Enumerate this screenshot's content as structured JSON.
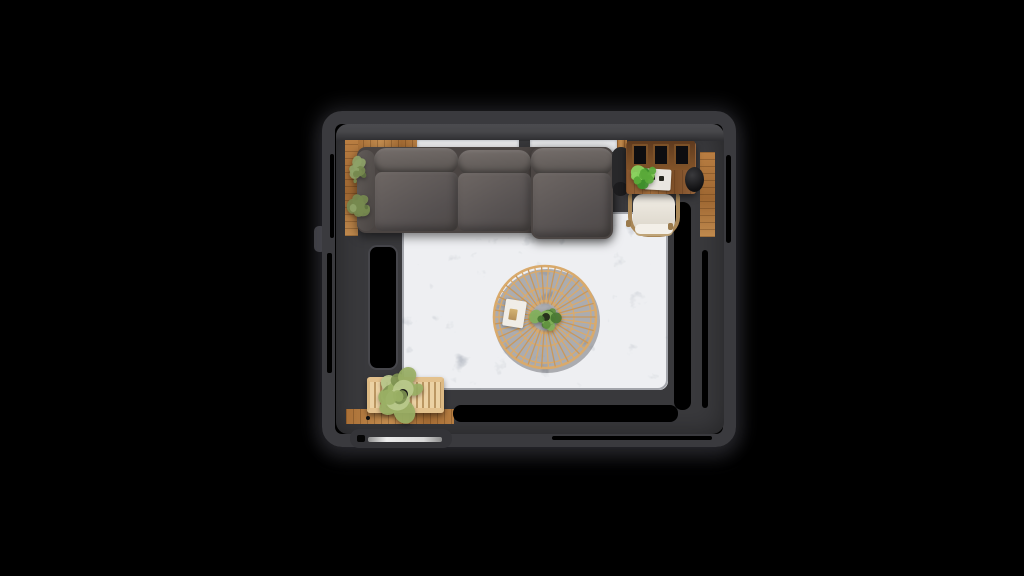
{
  "meta": {
    "description": "Top-down 3D interior render of a living room on a black background",
    "image_type": "3d-room-render-top-view",
    "visible_text": "none"
  },
  "theme": {
    "bg": "#000000",
    "wall": "#3a3a3e",
    "wall_surface": "#39393c",
    "wall_highlight": "#4b4b4f",
    "wall_shadow": "#2d2d30",
    "window": "#e9eaec",
    "wood_floor": "#b0763b",
    "wood_floor_light": "#c28c4f",
    "desk_wood": "#8a5830",
    "bench_wood": "#ecd2a4",
    "rug_base": "#b9bdc4",
    "rug_dark_mottle": "#8f959e",
    "rug_light_mottle": "#e2e4e7",
    "leather": "#5c5654",
    "leather_light": "#6e6764",
    "leather_dark": "#4a4442",
    "rattan": "#d9aa6c",
    "chair_wood": "#a98757",
    "chair_cream": "#eae5dd",
    "magazine": "#f0ede7",
    "door_white": "#e0e0e0"
  },
  "room": {
    "windows_on_top_wall": 2,
    "left_wall_opening": "black window/door cutout",
    "bottom_left": "white door slab in wall",
    "floor": [
      "wood border strips",
      "gray marble-pattern area rug"
    ]
  },
  "furniture": [
    {
      "name": "sectional-sofa",
      "seats": 3,
      "chaise_side": "right",
      "color": "#5c5654"
    },
    {
      "name": "rattan-coffee-table",
      "shape": "round",
      "color": "#d9aa6c"
    },
    {
      "name": "magazine",
      "color": "#f0ede7"
    },
    {
      "name": "desk",
      "frames_on_shelf": 3,
      "color": "#8a5830"
    },
    {
      "name": "desk-chair",
      "cushion": "#eae5dd",
      "frame": "#a98757"
    },
    {
      "name": "speaker",
      "color": "#1b1b1d"
    },
    {
      "name": "side-lamp",
      "color": "#28282a"
    },
    {
      "name": "bench",
      "style": "slatted",
      "color": "#ecd2a4"
    },
    {
      "name": "door",
      "color": "#e0e0e0"
    }
  ],
  "table": {
    "cx": 545,
    "cy": 317,
    "spokes": 46,
    "inner_radius": 14,
    "outer_radius": 50,
    "rings": [
      51,
      46,
      29,
      16
    ],
    "color": "#d9aa6c",
    "alt_color": "#c9985c"
  },
  "plants": [
    {
      "name": "wall-plant-1",
      "cx": 357,
      "cy": 171,
      "r": 14,
      "n": 9,
      "seed": 11,
      "colors": [
        "#76894f",
        "#8ea268",
        "#5f7240"
      ]
    },
    {
      "name": "wall-plant-2",
      "cx": 359,
      "cy": 205,
      "r": 15,
      "n": 10,
      "seed": 23,
      "colors": [
        "#76894f",
        "#8ea268",
        "#5f7240"
      ]
    },
    {
      "name": "bench-plant",
      "cx": 403,
      "cy": 394,
      "r": 27,
      "n": 15,
      "seed": 7,
      "colors": [
        "#9ab065",
        "#bac98c",
        "#7d9150"
      ],
      "pot": {
        "color": "#151515",
        "r": 5
      }
    },
    {
      "name": "desk-plant",
      "cx": 643,
      "cy": 176,
      "r": 16,
      "n": 12,
      "seed": 5,
      "colors": [
        "#5aa93a",
        "#8bd260",
        "#3f8f2c"
      ]
    },
    {
      "name": "table-plant",
      "cx": 546,
      "cy": 317,
      "r": 15,
      "n": 13,
      "seed": 19,
      "colors": [
        "#61913f",
        "#82b15a",
        "#4a7a33"
      ],
      "pot": {
        "color": "#27311c",
        "r": 4
      }
    }
  ]
}
